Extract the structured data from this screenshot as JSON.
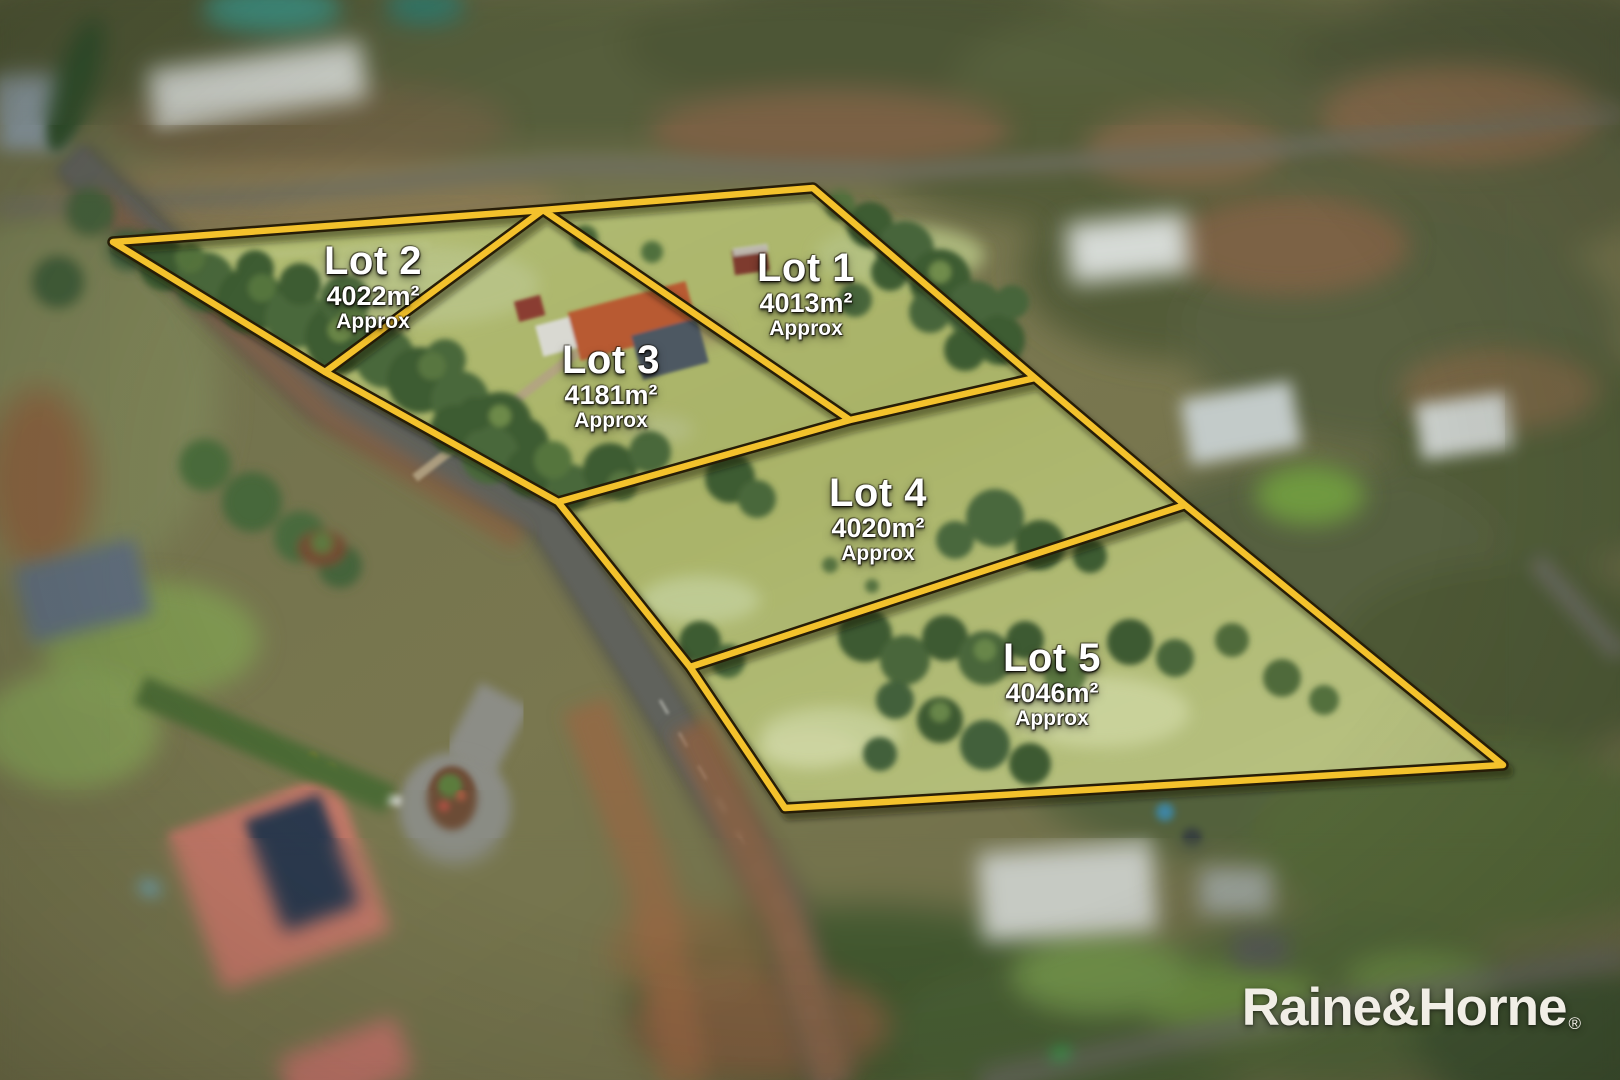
{
  "lots": [
    {
      "name": "Lot 1",
      "area": "4013m²",
      "qualifier": "Approx"
    },
    {
      "name": "Lot 2",
      "area": "4022m²",
      "qualifier": "Approx"
    },
    {
      "name": "Lot 3",
      "area": "4181m²",
      "qualifier": "Approx"
    },
    {
      "name": "Lot 4",
      "area": "4020m²",
      "qualifier": "Approx"
    },
    {
      "name": "Lot 5",
      "area": "4046m²",
      "qualifier": "Approx"
    }
  ],
  "watermark": {
    "logo_text": "Raine&Horne",
    "registered_mark": "®"
  },
  "colors": {
    "boundary_yellow": "#F4C22C",
    "boundary_outline": "#271D07",
    "label_text": "#FFFFFF",
    "logo_text": "#F1EEE6"
  }
}
